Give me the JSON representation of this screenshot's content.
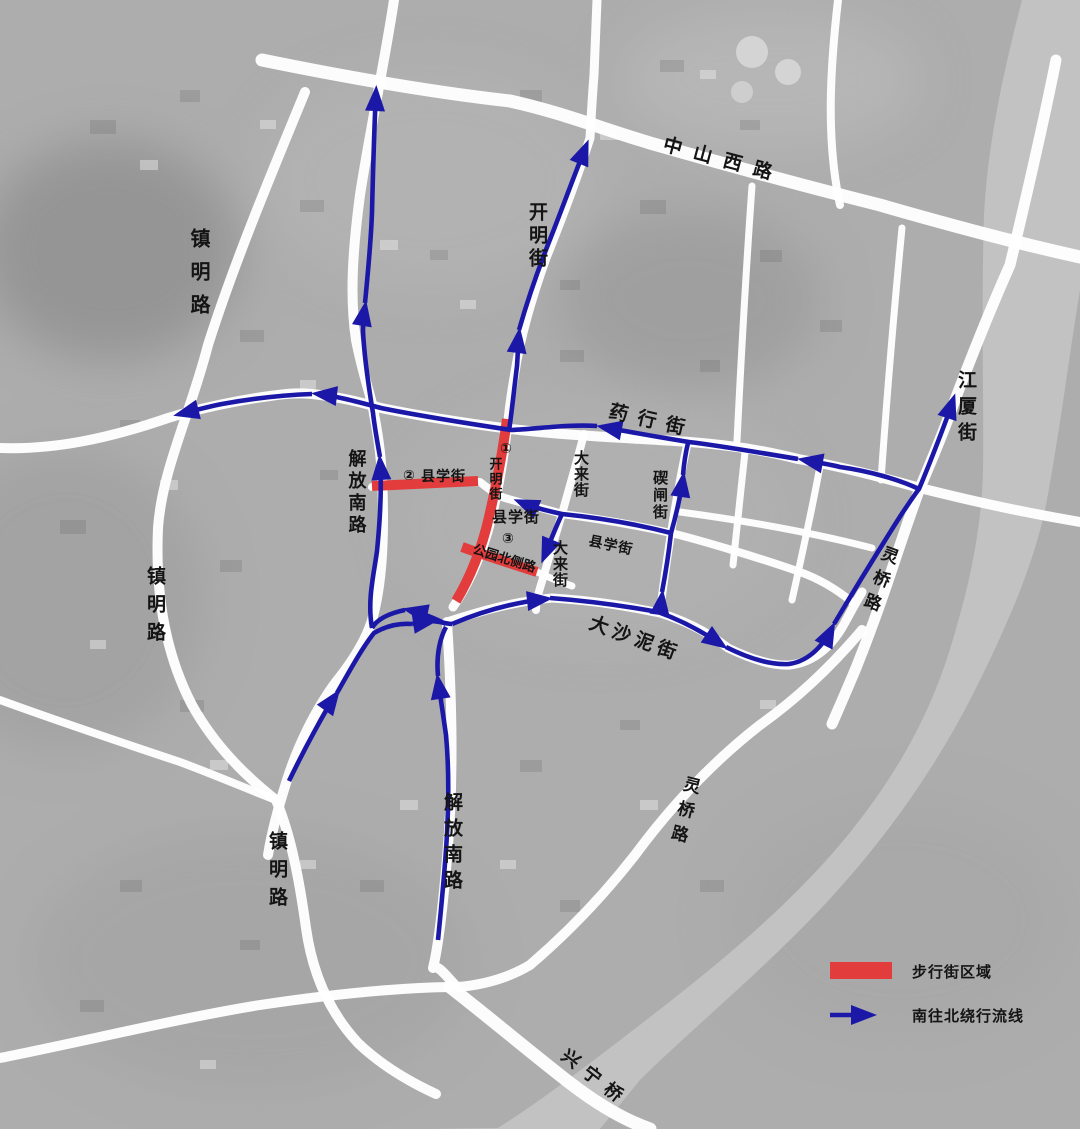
{
  "map": {
    "description": "Satellite detour map of Ningbo city center pedestrian zone",
    "labels": {
      "zhongshan_xi_lu": "中山西路",
      "kaiming_jie_north": "开明街",
      "zhenming_lu_1": "镇明路",
      "yaohang_jie": "药行街",
      "jiangxia_jie": "江厦街",
      "jiefang_nan_lu_1": "解放南路",
      "xianxue_jie_red": "县学街",
      "kaiming_jie_red": "开明街",
      "dalai_jie_1": "大来街",
      "qizha_jie": "碶闸街",
      "xianxue_jie_center": "县学街",
      "gongyuan_bei_ce_lu": "公园北侧路",
      "dalai_jie_2": "大来街",
      "xianxue_jie_east": "县学街",
      "zhenming_lu_2": "镇明路",
      "dashani_jie": "大沙泥街",
      "lingqiao_lu_1": "灵桥路",
      "lingqiao_lu_2": "灵桥路",
      "jiefang_nan_lu_2": "解放南路",
      "zhenming_lu_3": "镇明路",
      "xingning_qiao": "兴宁桥"
    },
    "zone_markers": {
      "m1": "①",
      "m2": "②",
      "m3": "③"
    }
  },
  "legend": {
    "pedestrian_zone": "步行街区域",
    "detour_flow": "南往北绕行流线"
  },
  "colors": {
    "detour_blue": "#1b18a8",
    "pedestrian_red": "#e23c3c",
    "road_white": "#ffffff",
    "river_gray": "#c2c2c2",
    "land_gray": "#adadad",
    "label_black": "#141414"
  }
}
